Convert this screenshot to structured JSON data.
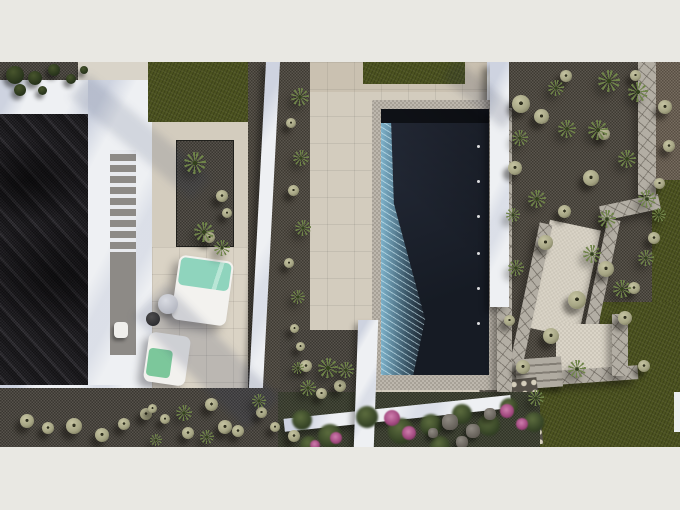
{
  "meta": {
    "content_type": "photorealistic-aerial-render",
    "subject": "Top-down 3D architectural visualization of a modern white villa with dark gravel roof courtyard, sun-lounger terrace, rectangular dark-water swimming pool and xeriscape gravel gardens with lawn"
  },
  "frame": {
    "width": 680,
    "height": 510,
    "content_top": 62,
    "content_height": 385
  },
  "palette": {
    "letterbox": "#e9e8e3",
    "terrace": "#d3ccbe",
    "terrace_light": "#dad3c5",
    "white_wall": "#eef0f3",
    "dark_roof": "#232126",
    "gravel": "#46423a",
    "gravel_warm": "#4b453c",
    "lawn": "#4c5320",
    "pool_water": "#262c3a",
    "pool_deep": "#161b24",
    "caustic": "#6fa9c0",
    "coping": "#b5afa4",
    "flagstone": "#b3aea4",
    "mint": "#8fd4bd",
    "towel_green": "#7cc79b",
    "ball": "#a6a584",
    "agave": "#6f8449",
    "flower": "#a34a80",
    "rock": "#7a756e",
    "steps": "#a39e94",
    "path_beige": "#d8d2c4"
  },
  "scene": {
    "pool": {
      "jets": [
        {
          "x": 96,
          "y": 36
        },
        {
          "x": 96,
          "y": 71
        },
        {
          "x": 96,
          "y": 106
        },
        {
          "x": 96,
          "y": 143
        },
        {
          "x": 96,
          "y": 178
        },
        {
          "x": 96,
          "y": 213
        }
      ]
    },
    "plants": {
      "bushes": [
        {
          "x": 6,
          "y": 4,
          "d": 18
        },
        {
          "x": 28,
          "y": 9,
          "d": 14
        },
        {
          "x": 48,
          "y": 2,
          "d": 12
        },
        {
          "x": 66,
          "y": 12,
          "d": 10
        },
        {
          "x": 14,
          "y": 22,
          "d": 12
        },
        {
          "x": 38,
          "y": 24,
          "d": 9
        },
        {
          "x": 80,
          "y": 4,
          "d": 8
        }
      ],
      "balls": [
        {
          "x": 20,
          "y": 352,
          "d": 14
        },
        {
          "x": 42,
          "y": 360,
          "d": 12
        },
        {
          "x": 66,
          "y": 356,
          "d": 16
        },
        {
          "x": 95,
          "y": 366,
          "d": 14
        },
        {
          "x": 118,
          "y": 356,
          "d": 12
        },
        {
          "x": 140,
          "y": 346,
          "d": 12
        },
        {
          "x": 160,
          "y": 352,
          "d": 10
        },
        {
          "x": 182,
          "y": 365,
          "d": 12
        },
        {
          "x": 205,
          "y": 336,
          "d": 13
        },
        {
          "x": 218,
          "y": 358,
          "d": 14
        },
        {
          "x": 232,
          "y": 363,
          "d": 12
        },
        {
          "x": 256,
          "y": 345,
          "d": 11
        },
        {
          "x": 270,
          "y": 360,
          "d": 10
        },
        {
          "x": 288,
          "y": 368,
          "d": 12
        },
        {
          "x": 148,
          "y": 342,
          "d": 9
        },
        {
          "x": 300,
          "y": 298,
          "d": 12
        },
        {
          "x": 316,
          "y": 326,
          "d": 11
        },
        {
          "x": 334,
          "y": 318,
          "d": 12
        },
        {
          "x": 296,
          "y": 280,
          "d": 9
        },
        {
          "x": 286,
          "y": 56,
          "d": 10
        },
        {
          "x": 288,
          "y": 123,
          "d": 11
        },
        {
          "x": 284,
          "y": 196,
          "d": 10
        },
        {
          "x": 290,
          "y": 262,
          "d": 9
        },
        {
          "x": 216,
          "y": 128,
          "d": 12
        },
        {
          "x": 222,
          "y": 146,
          "d": 10
        },
        {
          "x": 204,
          "y": 170,
          "d": 11
        },
        {
          "x": 512,
          "y": 33,
          "d": 18
        },
        {
          "x": 534,
          "y": 47,
          "d": 15
        },
        {
          "x": 508,
          "y": 99,
          "d": 14
        },
        {
          "x": 583,
          "y": 108,
          "d": 16
        },
        {
          "x": 558,
          "y": 143,
          "d": 13
        },
        {
          "x": 538,
          "y": 173,
          "d": 15
        },
        {
          "x": 598,
          "y": 199,
          "d": 16
        },
        {
          "x": 568,
          "y": 229,
          "d": 18
        },
        {
          "x": 618,
          "y": 249,
          "d": 14
        },
        {
          "x": 543,
          "y": 266,
          "d": 16
        },
        {
          "x": 638,
          "y": 298,
          "d": 12
        },
        {
          "x": 658,
          "y": 38,
          "d": 14
        },
        {
          "x": 663,
          "y": 78,
          "d": 12
        },
        {
          "x": 654,
          "y": 116,
          "d": 11
        },
        {
          "x": 516,
          "y": 298,
          "d": 14
        },
        {
          "x": 504,
          "y": 253,
          "d": 11
        },
        {
          "x": 560,
          "y": 8,
          "d": 12
        },
        {
          "x": 630,
          "y": 8,
          "d": 11
        },
        {
          "x": 598,
          "y": 66,
          "d": 12
        },
        {
          "x": 648,
          "y": 170,
          "d": 12
        },
        {
          "x": 628,
          "y": 220,
          "d": 12
        }
      ],
      "agaves": [
        {
          "x": 184,
          "y": 90,
          "d": 22
        },
        {
          "x": 194,
          "y": 160,
          "d": 20
        },
        {
          "x": 214,
          "y": 178,
          "d": 16
        },
        {
          "x": 291,
          "y": 26,
          "d": 18
        },
        {
          "x": 293,
          "y": 88,
          "d": 16
        },
        {
          "x": 295,
          "y": 158,
          "d": 16
        },
        {
          "x": 291,
          "y": 228,
          "d": 14
        },
        {
          "x": 318,
          "y": 296,
          "d": 20
        },
        {
          "x": 338,
          "y": 300,
          "d": 16
        },
        {
          "x": 300,
          "y": 318,
          "d": 16
        },
        {
          "x": 292,
          "y": 300,
          "d": 12
        },
        {
          "x": 176,
          "y": 343,
          "d": 16
        },
        {
          "x": 200,
          "y": 368,
          "d": 14
        },
        {
          "x": 252,
          "y": 332,
          "d": 14
        },
        {
          "x": 150,
          "y": 372,
          "d": 12
        },
        {
          "x": 598,
          "y": 8,
          "d": 22
        },
        {
          "x": 628,
          "y": 20,
          "d": 20
        },
        {
          "x": 588,
          "y": 58,
          "d": 20
        },
        {
          "x": 618,
          "y": 88,
          "d": 18
        },
        {
          "x": 638,
          "y": 128,
          "d": 18
        },
        {
          "x": 598,
          "y": 148,
          "d": 18
        },
        {
          "x": 583,
          "y": 183,
          "d": 18
        },
        {
          "x": 613,
          "y": 218,
          "d": 18
        },
        {
          "x": 638,
          "y": 188,
          "d": 16
        },
        {
          "x": 558,
          "y": 58,
          "d": 18
        },
        {
          "x": 528,
          "y": 128,
          "d": 18
        },
        {
          "x": 508,
          "y": 198,
          "d": 16
        },
        {
          "x": 568,
          "y": 298,
          "d": 18
        },
        {
          "x": 528,
          "y": 328,
          "d": 16
        },
        {
          "x": 548,
          "y": 18,
          "d": 16
        },
        {
          "x": 512,
          "y": 68,
          "d": 16
        },
        {
          "x": 506,
          "y": 146,
          "d": 14
        },
        {
          "x": 652,
          "y": 146,
          "d": 14
        }
      ],
      "shrubs": [
        {
          "x": 292,
          "y": 348,
          "d": 20
        },
        {
          "x": 318,
          "y": 362,
          "d": 24
        },
        {
          "x": 356,
          "y": 344,
          "d": 22
        },
        {
          "x": 388,
          "y": 356,
          "d": 26
        },
        {
          "x": 420,
          "y": 352,
          "d": 22
        },
        {
          "x": 452,
          "y": 342,
          "d": 20
        },
        {
          "x": 478,
          "y": 352,
          "d": 22
        },
        {
          "x": 300,
          "y": 374,
          "d": 18
        },
        {
          "x": 430,
          "y": 374,
          "d": 20
        },
        {
          "x": 500,
          "y": 336,
          "d": 18
        },
        {
          "x": 524,
          "y": 350,
          "d": 20
        }
      ],
      "flowers": [
        {
          "x": 384,
          "y": 348,
          "d": 16
        },
        {
          "x": 402,
          "y": 364,
          "d": 14
        },
        {
          "x": 330,
          "y": 370,
          "d": 12
        },
        {
          "x": 500,
          "y": 342,
          "d": 14
        },
        {
          "x": 516,
          "y": 356,
          "d": 12
        },
        {
          "x": 310,
          "y": 378,
          "d": 10
        }
      ],
      "rocks": [
        {
          "x": 442,
          "y": 352,
          "d": 16
        },
        {
          "x": 466,
          "y": 362,
          "d": 14
        },
        {
          "x": 484,
          "y": 346,
          "d": 12
        },
        {
          "x": 456,
          "y": 374,
          "d": 12
        },
        {
          "x": 428,
          "y": 366,
          "d": 10
        }
      ]
    }
  }
}
